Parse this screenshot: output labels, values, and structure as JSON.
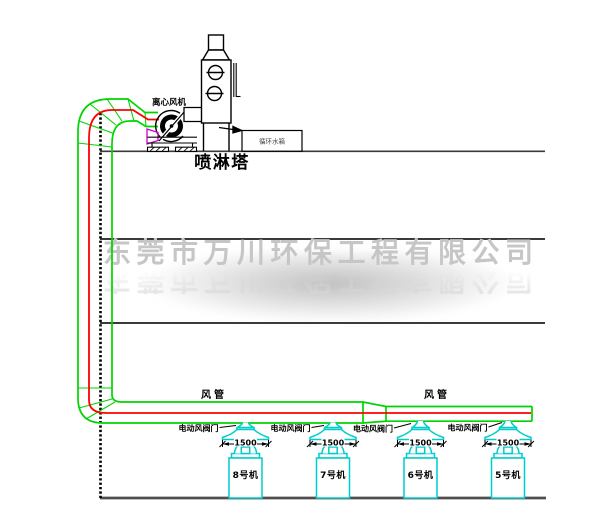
{
  "watermark": {
    "text": "东莞市万川环保工程有限公司"
  },
  "equipment": {
    "fan_label": "离心风机",
    "tower_label": "喷淋塔",
    "tank_label": "循环水箱"
  },
  "duct": {
    "duct_label_left": "风管",
    "duct_label_right": "风管"
  },
  "valves": [
    {
      "label": "电动风阀门"
    },
    {
      "label": "电动风阀门"
    },
    {
      "label": "电动风阀门"
    },
    {
      "label": "电动风阀门"
    }
  ],
  "dimensions": [
    {
      "value": "1500"
    },
    {
      "value": "1500"
    },
    {
      "value": "1500"
    },
    {
      "value": "1500"
    }
  ],
  "machines": [
    {
      "label": "8号机"
    },
    {
      "label": "7号机"
    },
    {
      "label": "6号机"
    },
    {
      "label": "5号机"
    }
  ],
  "colors": {
    "duct_green": "#00d400",
    "pipe_red": "#ff0000",
    "machine_cyan": "#00cccc",
    "line_black": "#000000",
    "floor_gray": "#4f4f4f",
    "watermark_gray": "#c6c6c6",
    "inlet_magenta": "#cc00cc"
  }
}
